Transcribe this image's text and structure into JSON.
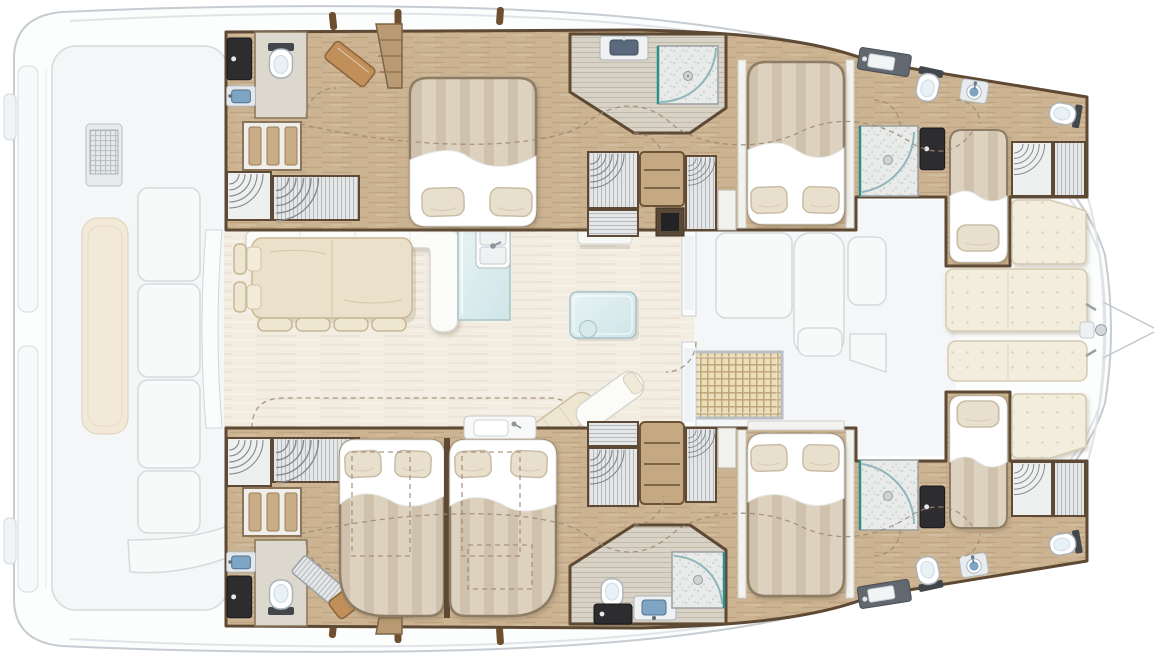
{
  "document": {
    "description": "Top-down interior layout plan of a sailing catamaran; no text labels are rendered in the image"
  },
  "palette": {
    "hull": "#fcfdfd",
    "hullStroke": "#c6ccd1",
    "deckLine": "#e0e4e8",
    "faded": "#f4f6f7",
    "fadedStroke": "#d5dadd",
    "fadedFurn": "#f8fafa",
    "wall": "#5d4934",
    "wood": "#ccb392",
    "salonFloor": "#f2ece1",
    "bathFloor": "#d9d2c6",
    "bedStripeA": "#ddd2c0",
    "bedStripeB": "#cdbfa8",
    "bedStroke": "#8d7d65",
    "sheet": "#ffffff",
    "pillow": "#e8dfcd",
    "pillowStroke": "#c9bda6",
    "sofa": "#fbfbf9",
    "sofaStroke": "#d8d8d2",
    "tableWood": "#ebe1ca",
    "tableStroke": "#c9b893",
    "chair": "#efe6d2",
    "chairStroke": "#c6b794",
    "glass": "#cfe5e8",
    "glassHi": "#e8f3f4",
    "glassStroke": "#a7c3c7",
    "sinkBlue": "#7ea6c4",
    "sinkBlueDark": "#4f7194",
    "doorBlack": "#2d2d30",
    "wcBack": "#42474c",
    "wcStroke": "#aab3ba",
    "wardrobe": "#e4e6e7",
    "wardrobeLine": "#b5b9bc",
    "arc": "#84898e",
    "shelfWood": "#c4a983",
    "shelfLine": "#7c6647",
    "speckBase": "#e9ebea",
    "speckDot": "#bdc2c1",
    "teal": "#2e8f8a",
    "quilt": "#f3edde",
    "quiltDot": "#dcd0b6",
    "quiltStroke": "#d6cab2",
    "waffleBase": "#eadfb9",
    "waffleLine": "#bda076",
    "tan": "#c08f5a",
    "tanStroke": "#8d6437",
    "dash": "#9b8a72",
    "tick": "#6e4f30",
    "benchCream": "#f3e9d8"
  },
  "plan": {
    "vessel": "catamaran",
    "view": "interior floor plan, bow to the right, exterior decks shown faded",
    "areas": [
      {
        "name": "aft-cockpit",
        "exterior": true,
        "items": [
          "swim-platform-steps",
          "outdoor-module-with-grate",
          "bench-seat-cushion",
          "cockpit-sofa-panels",
          "aft-curved-bench",
          "salon-sliding-door"
        ]
      },
      {
        "name": "salon",
        "exterior": false,
        "items": [
          "l-shaped-sofa",
          "dining-table",
          "side-chair",
          "side-chair",
          "dining-chair",
          "dining-chair",
          "dining-chair",
          "dining-chair",
          "galley-counter-with-double-sink",
          "glass-coffee-table",
          "chaise-lounger",
          "chaise-lounger",
          "companionway-steps",
          "storage-locker",
          "forward-door"
        ]
      },
      {
        "name": "port-hull",
        "exterior": false,
        "rooms": [
          {
            "name": "aft-head",
            "items": [
              "wc-door",
              "toilet",
              "washbasin",
              "slatted-locker",
              "hanging-locker",
              "hanging-locker",
              "angled-locker",
              "entry-steps"
            ]
          },
          {
            "name": "aft-cabin",
            "items": [
              "double-bed",
              "pillow",
              "pillow"
            ]
          },
          {
            "name": "mid-bathroom",
            "items": [
              "washbasin",
              "shower"
            ]
          },
          {
            "name": "dressing-area",
            "items": [
              "hanging-locker",
              "hanging-locker",
              "shelf-column",
              "dark-locker"
            ]
          },
          {
            "name": "mid-cabin",
            "items": [
              "double-bed",
              "pillow",
              "pillow"
            ]
          },
          {
            "name": "forward-bathroom",
            "items": [
              "washbasin",
              "toilet",
              "shower",
              "wc-door"
            ]
          },
          {
            "name": "forward-cabin",
            "items": [
              "single-berth",
              "pillow",
              "washbasin",
              "hanging-locker",
              "louvered-locker"
            ]
          },
          {
            "name": "bow-head",
            "items": [
              "toilet"
            ]
          }
        ]
      },
      {
        "name": "starboard-hull",
        "exterior": false,
        "rooms": [
          {
            "name": "aft-head",
            "items": [
              "wc-door",
              "toilet",
              "washbasin",
              "slatted-locker",
              "hanging-locker",
              "hanging-locker",
              "angled-louver-panel",
              "angled-locker",
              "entry-steps"
            ]
          },
          {
            "name": "aft-cabin",
            "items": [
              "double-bed",
              "double-bed",
              "pillow",
              "pillow",
              "pillow",
              "pillow",
              "vanity-washbasin",
              "optional-layout-dashed-outline"
            ]
          },
          {
            "name": "dressing-area",
            "items": [
              "hanging-locker",
              "hanging-locker",
              "shelf-column"
            ]
          },
          {
            "name": "mid-bathroom",
            "items": [
              "toilet",
              "washbasin",
              "shower",
              "wc-door"
            ]
          },
          {
            "name": "mid-cabin",
            "items": [
              "double-bed",
              "pillow",
              "pillow"
            ]
          },
          {
            "name": "forward-bathroom",
            "items": [
              "washbasin",
              "toilet",
              "shower",
              "wc-door"
            ]
          },
          {
            "name": "forward-cabin",
            "items": [
              "single-berth",
              "pillow",
              "washbasin",
              "hanging-locker",
              "louvered-locker"
            ]
          },
          {
            "name": "bow-head",
            "items": [
              "toilet"
            ]
          }
        ]
      },
      {
        "name": "forward-cockpit",
        "exterior": true,
        "items": [
          "lounge-sofa",
          "lounge-sofa-back",
          "low-table",
          "woven-mat",
          "mast-bench"
        ]
      },
      {
        "name": "foredeck",
        "exterior": true,
        "items": [
          "quilted-sunpad",
          "quilted-sunpad",
          "quilted-sunpad",
          "quilted-sunpad",
          "anchor-windlass",
          "bowsprit-bridle"
        ]
      }
    ],
    "counts": {
      "cabins": 6,
      "berths": 7,
      "double_beds": 5,
      "single_beds": 2,
      "toilets": 7,
      "showers": 4,
      "washbasins": 10
    }
  }
}
